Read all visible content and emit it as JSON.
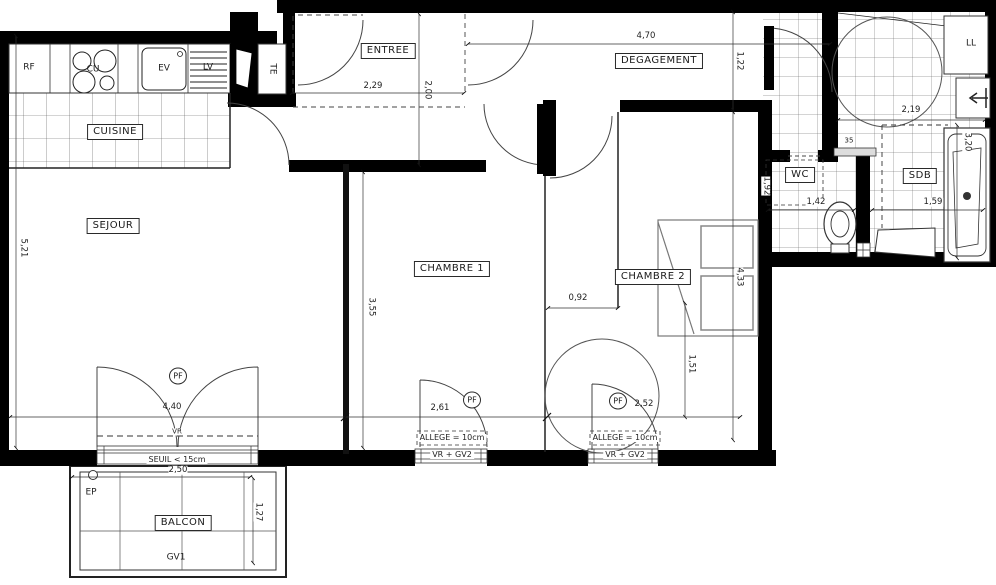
{
  "rooms": {
    "cuisine": "CUISINE",
    "sejour": "SEJOUR",
    "entree": "ENTREE",
    "degagement": "DEGAGEMENT",
    "chambre1": "CHAMBRE 1",
    "chambre2": "CHAMBRE 2",
    "wc": "WC",
    "sdb": "SDB",
    "balcon": "BALCON"
  },
  "equipment": {
    "rf": "RF",
    "cu": "CU",
    "ev": "EV",
    "lv": "LV",
    "te": "TE",
    "ll": "LL",
    "ep": "EP",
    "gv1": "GV1",
    "vr": "VR",
    "pf": "PF",
    "shelf": "35"
  },
  "annotations": {
    "seuil": "SEUIL < 15cm",
    "allege": "ALLEGE = 10cm",
    "vr_gv2": "VR + GV2"
  },
  "dimensions": {
    "entree_width": "2,29",
    "entree_height": "2,00",
    "degagement_width": "4,70",
    "degagement_height": "1,22",
    "sdb_top_width": "2,19",
    "sdb_right_height": "3,20",
    "sejour_height": "5,21",
    "chambre1_height": "3,55",
    "chambre2_door": "0,92",
    "chambre2_height": "4,33",
    "chambre2_wall": "1,51",
    "wc_width": "1,42",
    "sdb_width": "1,59",
    "wc_height": "1,92",
    "sejour_width": "4,40",
    "chambre1_width": "2,61",
    "chambre2_width": "2,52",
    "balcon_width": "2,50",
    "balcon_depth": "1,27"
  },
  "colors": {
    "wall": "#000000",
    "line": "#333333",
    "tile": "#555555"
  }
}
